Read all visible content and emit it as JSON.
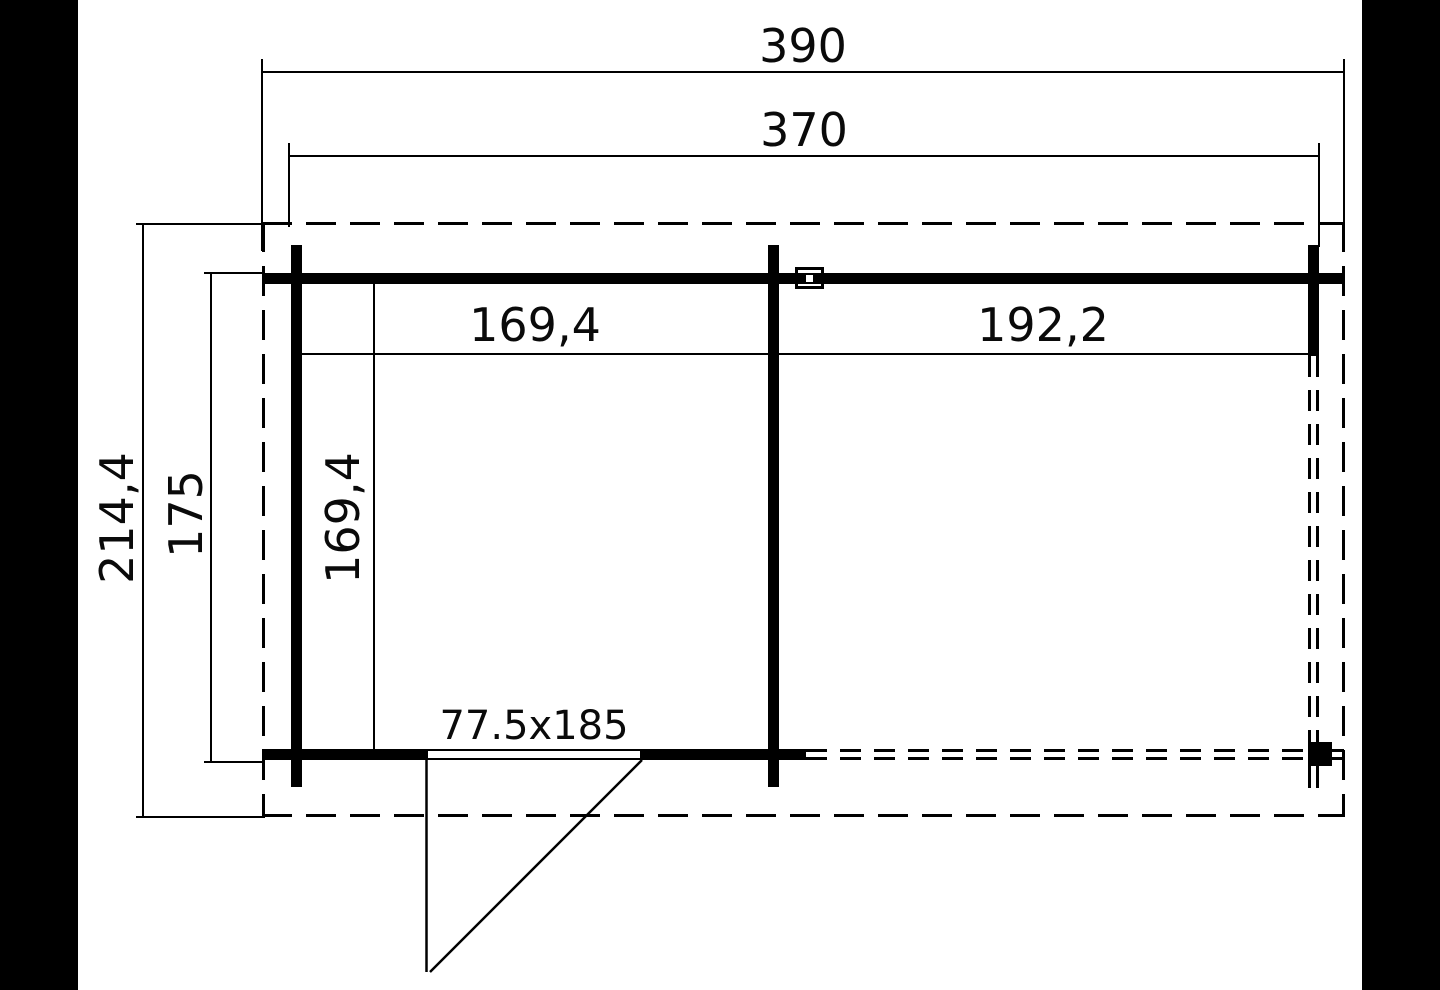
{
  "drawing": {
    "kind": "log-cabin floor plan, top view, black line work on white, letterboxed",
    "dimensions": {
      "overall_width": "390",
      "inner_width": "370",
      "overall_depth": "214,4",
      "inner_depth": "175",
      "left_room_width": "169,4",
      "left_room_depth": "169,4",
      "right_section_width": "192,2",
      "door_size": "77.5x185"
    },
    "colors": {
      "ink": "#000000",
      "paper": "#ffffff",
      "letterbox": "#000000"
    }
  }
}
